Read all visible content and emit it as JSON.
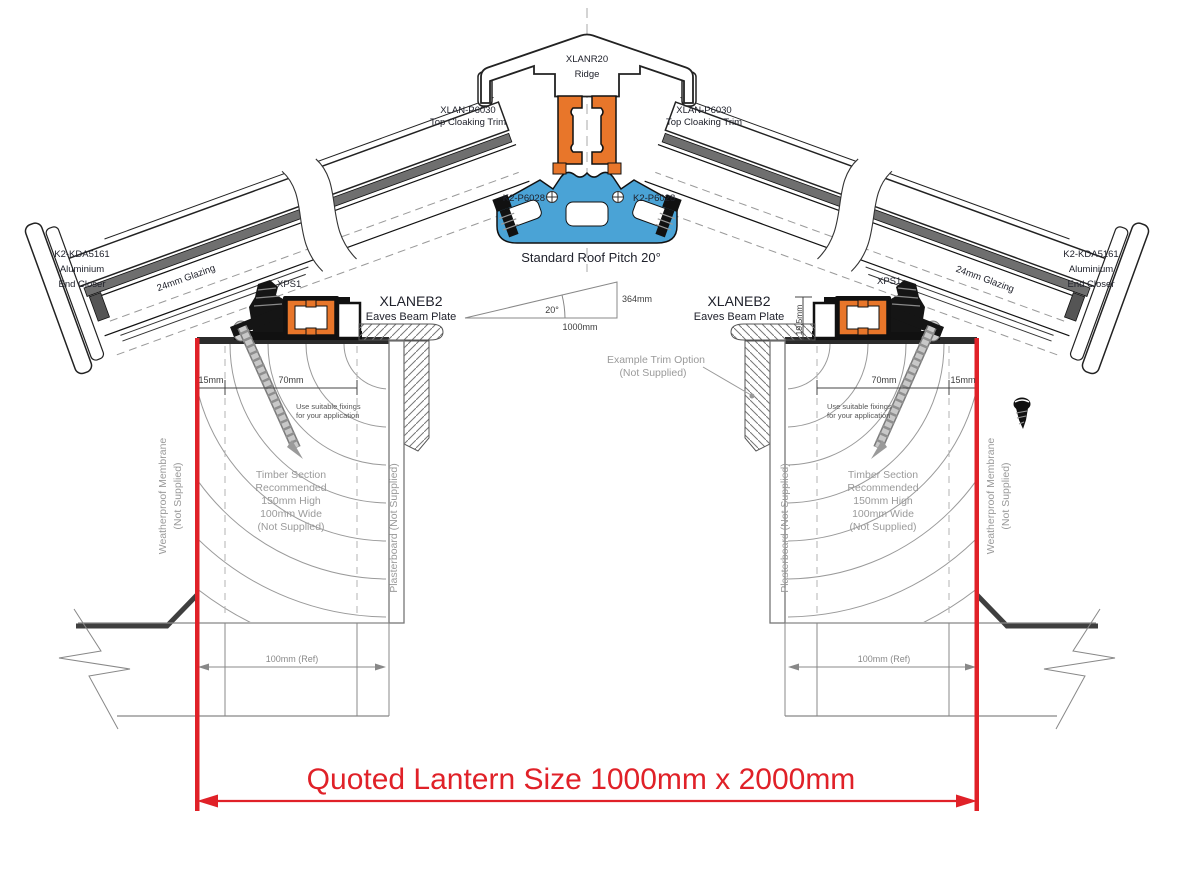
{
  "drawing_title": "Roof lantern cross section",
  "colors": {
    "accent_red": "#e02128",
    "profile_orange": "#e8762a",
    "profile_blue": "#4aa3d6",
    "label": "#20222c",
    "muted": "#9a9a9a"
  },
  "ridge": {
    "code": "XLANR20",
    "name": "Ridge"
  },
  "cloaking": {
    "left": {
      "code": "XLAN-P6030",
      "name": "Top Cloaking Trim"
    },
    "right": {
      "code": "XLAN-P6030",
      "name": "Top Cloaking Trim"
    }
  },
  "glazing_bar": {
    "left": "K2-P6028",
    "right": "K2-P6028"
  },
  "pitch": {
    "caption": "Standard Roof Pitch 20°",
    "angle": "20°",
    "rise": "364mm",
    "base": "1000mm"
  },
  "eaves": {
    "left": {
      "code": "XLANEB2",
      "name": "Eaves Beam Plate",
      "bracket": "XPS1"
    },
    "right": {
      "code": "XLANEB2",
      "name": "Eaves Beam Plate",
      "bracket": "XPS1",
      "plate_height": "19.5mm"
    }
  },
  "end_closer": {
    "left": [
      "K2-KDA5161",
      "Aluminium",
      "End Closer"
    ],
    "right": [
      "K2-KDA5161",
      "Aluminium",
      "End Closer"
    ]
  },
  "glazing": {
    "left": "24mm Glazing",
    "right": "24mm Glazing"
  },
  "dims": {
    "left": {
      "edge": "15mm",
      "center": "70mm",
      "ref": "100mm (Ref)"
    },
    "right": {
      "edge": "15mm",
      "center": "70mm",
      "ref": "100mm (Ref)"
    }
  },
  "fixing_note": [
    "Use suitable fixings",
    "for your application"
  ],
  "timber_note": [
    "Timber Section",
    "Recommended",
    "150mm High",
    "100mm Wide",
    "(Not Supplied)"
  ],
  "membrane_note": [
    "Weatherproof Membrane",
    "(Not Supplied)"
  ],
  "plasterboard_note": "Plasterboard (Not Supplied)",
  "trim_option_note": [
    "Example Trim Option",
    "(Not Supplied)"
  ],
  "quoted_size": "Quoted Lantern Size 1000mm x 2000mm"
}
